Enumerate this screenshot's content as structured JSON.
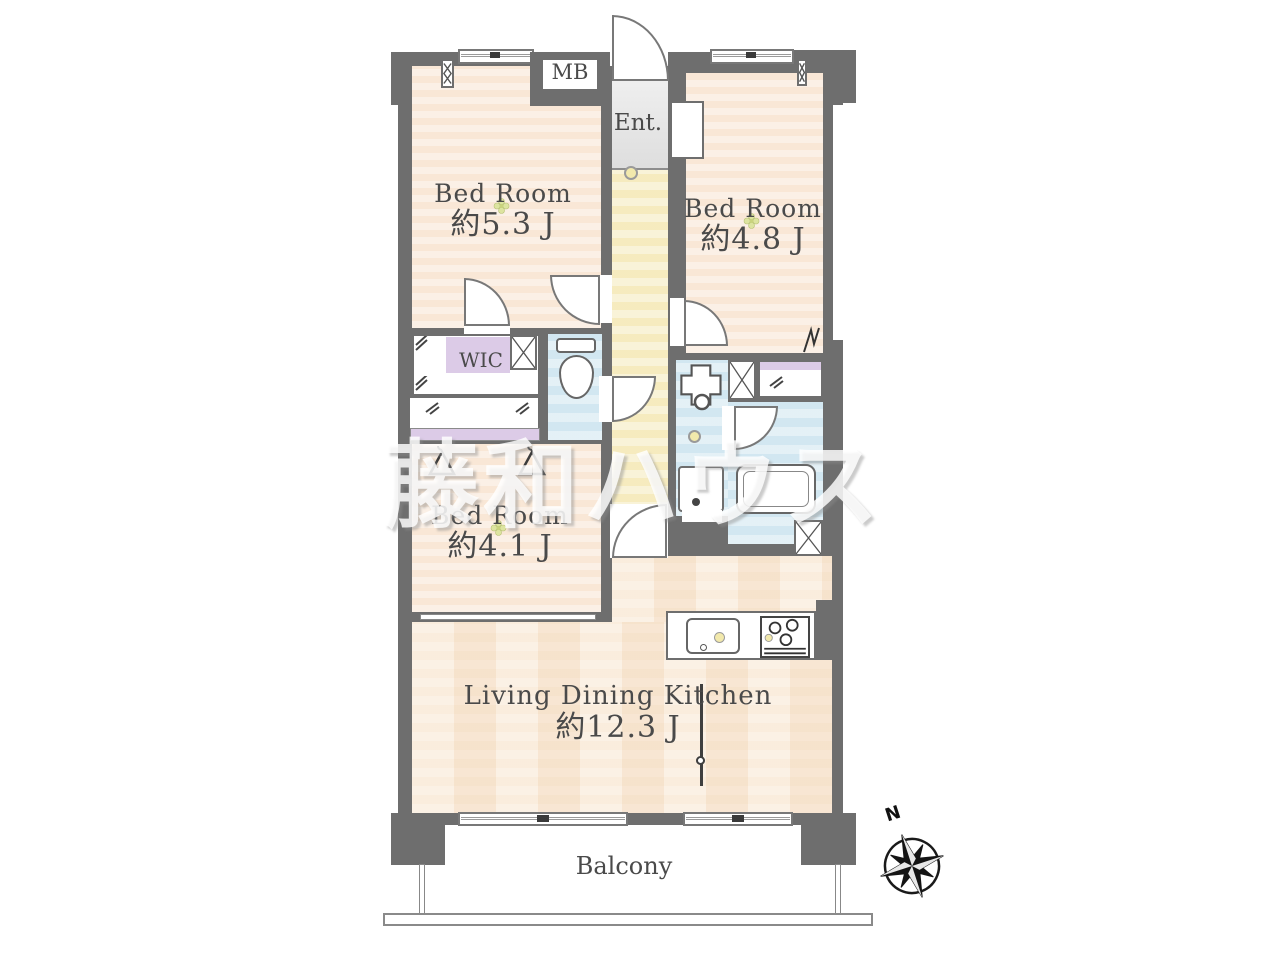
{
  "watermark": "藤和ハウス",
  "rooms": {
    "bedroom1": {
      "name": "Bed Room",
      "area": "約5.3 J"
    },
    "bedroom2": {
      "name": "Bed Room",
      "area": "約4.8 J"
    },
    "bedroom3": {
      "name": "Bed Room",
      "area": "約4.1 J"
    },
    "ldk": {
      "name": "Living Dining Kitchen",
      "area": "約12.3 J"
    },
    "entrance": {
      "label": "Ent."
    },
    "meter_box": {
      "label": "MB"
    },
    "wic": {
      "label": "WIC"
    },
    "balcony": {
      "label": "Balcony"
    }
  },
  "compass": {
    "north_label": "N"
  },
  "colors": {
    "wall": "#6e6e6e",
    "room_floor": "#faeadc",
    "hallway_floor": "#f7eec7",
    "wet_area": "#d5e9f2",
    "wic_floor": "#dccbe7",
    "entrance_floor": "#e4e4e4",
    "accent_dot": "#f2e9ac"
  }
}
